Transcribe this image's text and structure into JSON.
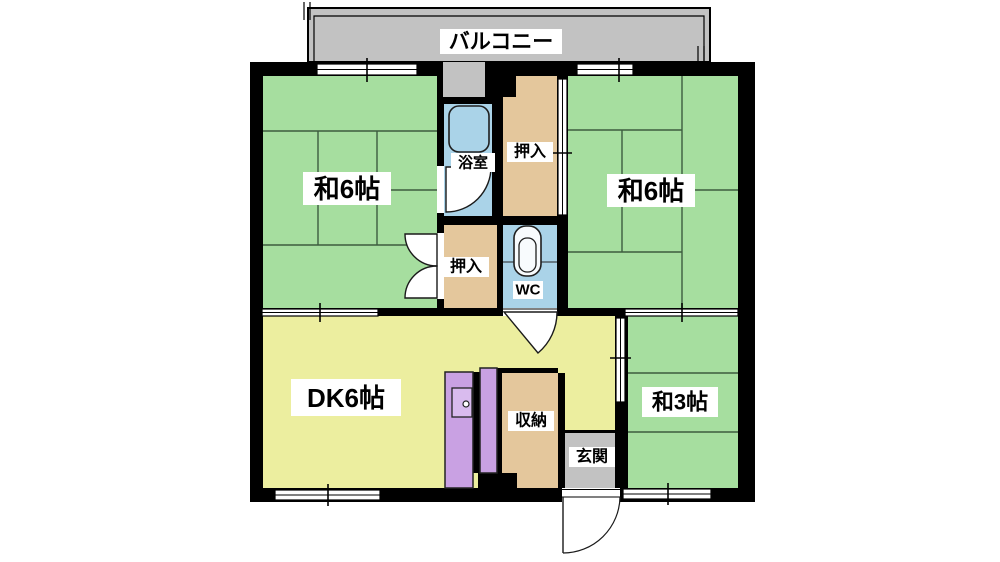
{
  "plan_title": "apartment-floorplan",
  "balcony": {
    "label": "バルコニー"
  },
  "rooms": {
    "washitsu_left": {
      "label": "和6帖"
    },
    "washitsu_right": {
      "label": "和6帖"
    },
    "bathroom": {
      "label": "浴室"
    },
    "closet_upper": {
      "label": "押入"
    },
    "closet_lower": {
      "label": "押入"
    },
    "wc": {
      "label": "WC"
    },
    "dining_kitchen": {
      "label": "DK6帖"
    },
    "storage": {
      "label": "収納"
    },
    "entrance": {
      "label": "玄関"
    },
    "washitsu_small": {
      "label": "和3帖"
    }
  },
  "icons": {
    "bathtub": "bathtub-icon",
    "toilet": "toilet-icon",
    "kitchen_sink": "kitchen-sink-icon"
  },
  "colors": {
    "tatami_room": "#a6de9f",
    "dining_kitchen": "#ecee9f",
    "closet": "#e4c79c",
    "wet_area": "#aad3e8",
    "kitchen_counter": "#c9a1e3",
    "balcony_entrance": "#c2c2c2",
    "wall": "#000000",
    "tatami_line": "#3d5c3f"
  }
}
